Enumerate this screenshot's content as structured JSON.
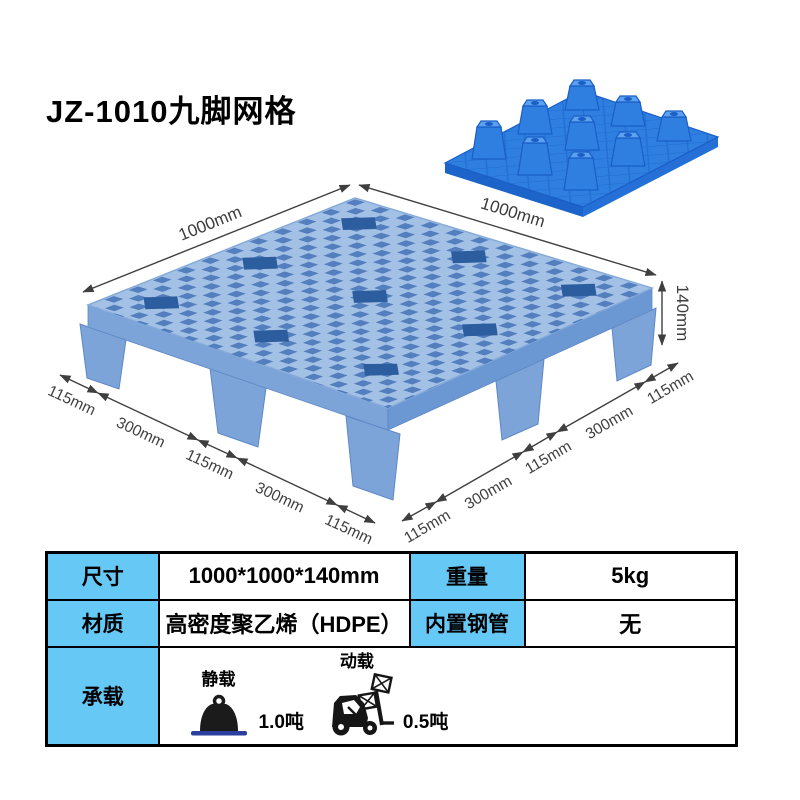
{
  "title": "JZ-1010九脚网格",
  "diagram": {
    "dim_top_left": "1000mm",
    "dim_top_right": "1000mm",
    "dim_height": "140mm",
    "left_segments": [
      "115mm",
      "300mm",
      "115mm",
      "300mm",
      "115mm"
    ],
    "right_segments": [
      "115mm",
      "300mm",
      "115mm",
      "300mm",
      "115mm"
    ]
  },
  "table": {
    "row1": {
      "label1": "尺寸",
      "value1": "1000*1000*140mm",
      "label2": "重量",
      "value2": "5kg"
    },
    "row2": {
      "label1": "材质",
      "value1": "高密度聚乙烯（HDPE）",
      "label2": "内置钢管",
      "value2": "无"
    },
    "row3": {
      "label": "承载",
      "static_label": "静载",
      "static_value": "1.0吨",
      "dynamic_label": "动载",
      "dynamic_value": "0.5吨"
    }
  },
  "colors": {
    "table_header_blue": "#66c8f5",
    "pallet_main_light": "#a3c0e5",
    "pallet_main_side": "#7ca4d9",
    "pallet_hole_blue": "#3f6fb5",
    "pallet_recess_blue": "#2c5d9e",
    "pallet_small_blue": "#2e7fe0",
    "pallet_small_dark": "#1a5ec6",
    "dimension_text": "#3f3f3f",
    "weight_base_blue": "#2a3f9e"
  },
  "icons": {
    "static_load": "weight-icon",
    "dynamic_load": "forklift-icon"
  }
}
